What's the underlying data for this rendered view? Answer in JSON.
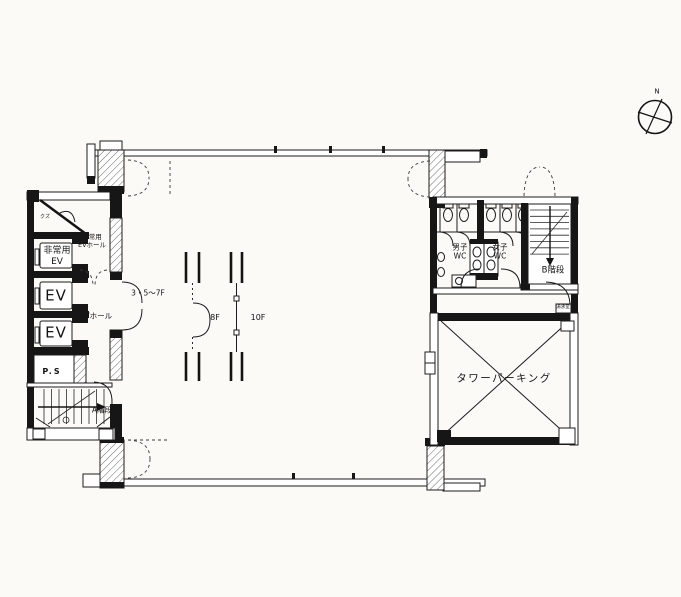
{
  "compass": {
    "north_label": "N"
  },
  "left_core": {
    "trash_room_label": "クズ",
    "emergency_ev_hall_label": "非常用\nEVホール",
    "emergency_ev_label": "非常用\nEV",
    "ev_label_1": "EV",
    "ev_label_2": "EV",
    "ev_hall_label": "EVホール",
    "pipe_shaft_label": "P.S",
    "stair_a_label": "A階段"
  },
  "floor_area": {
    "floors_3_5_7_label": "3・5〜7F",
    "floor_8_label": "8F",
    "floor_10_label": "10F"
  },
  "right_core": {
    "mens_wc_label": "男子\nWC",
    "womens_wc_label": "女子\nWC",
    "stair_b_label": "B階段",
    "kitchenette_label": "湯沸室",
    "tower_parking_label": "タワーパーキング"
  }
}
